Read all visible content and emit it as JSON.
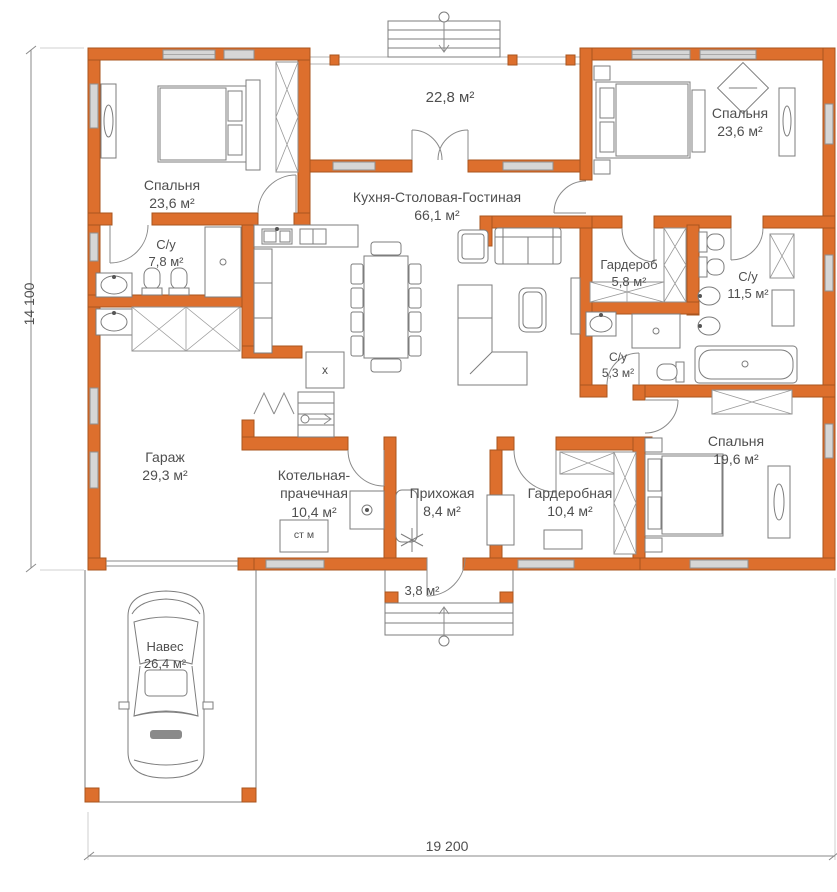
{
  "plan": {
    "dimensions": {
      "width_mm": "19 200",
      "height_mm": "14 100"
    },
    "rooms": {
      "terrace": {
        "area": "22,8 м²"
      },
      "bedroom_left": {
        "name": "Спальня",
        "area": "23,6 м²"
      },
      "bedroom_right_top": {
        "name": "Спальня",
        "area": "23,6 м²"
      },
      "kitchen_living": {
        "name": "Кухня-Столовая-Гостиная",
        "area": "66,1 м²"
      },
      "bathroom_left": {
        "name": "С/у",
        "area": "7,8 м²"
      },
      "wardrobe_small": {
        "name": "Гардероб",
        "area": "5,8 м²"
      },
      "bathroom_big": {
        "name": "С/у",
        "area": "11,5 м²"
      },
      "bathroom_small": {
        "name": "С/у",
        "area": "5,3 м²"
      },
      "garage": {
        "name": "Гараж",
        "area": "29,3 м²"
      },
      "boiler_laundry": {
        "name": "Котельная-прачечная",
        "area": "10,4 м²"
      },
      "hallway": {
        "name": "Прихожая",
        "area": "8,4 м²"
      },
      "dressing_room": {
        "name": "Гардеробная",
        "area": "10,4 м²"
      },
      "bedroom_right_bottom": {
        "name": "Спальня",
        "area": "19,6 м²"
      },
      "carport": {
        "name": "Навес",
        "area": "26,4 м²"
      },
      "porch": {
        "area": "3,8 м²"
      }
    },
    "labels": {
      "washing_machine": "ст м",
      "boiler_mark": "x"
    },
    "colors": {
      "wall_fill": "#dd6f2d",
      "wall_stroke": "#a9541e",
      "window_fill": "#d6d6d6",
      "line": "#7d7d7d",
      "text": "#4f4f4f"
    }
  }
}
